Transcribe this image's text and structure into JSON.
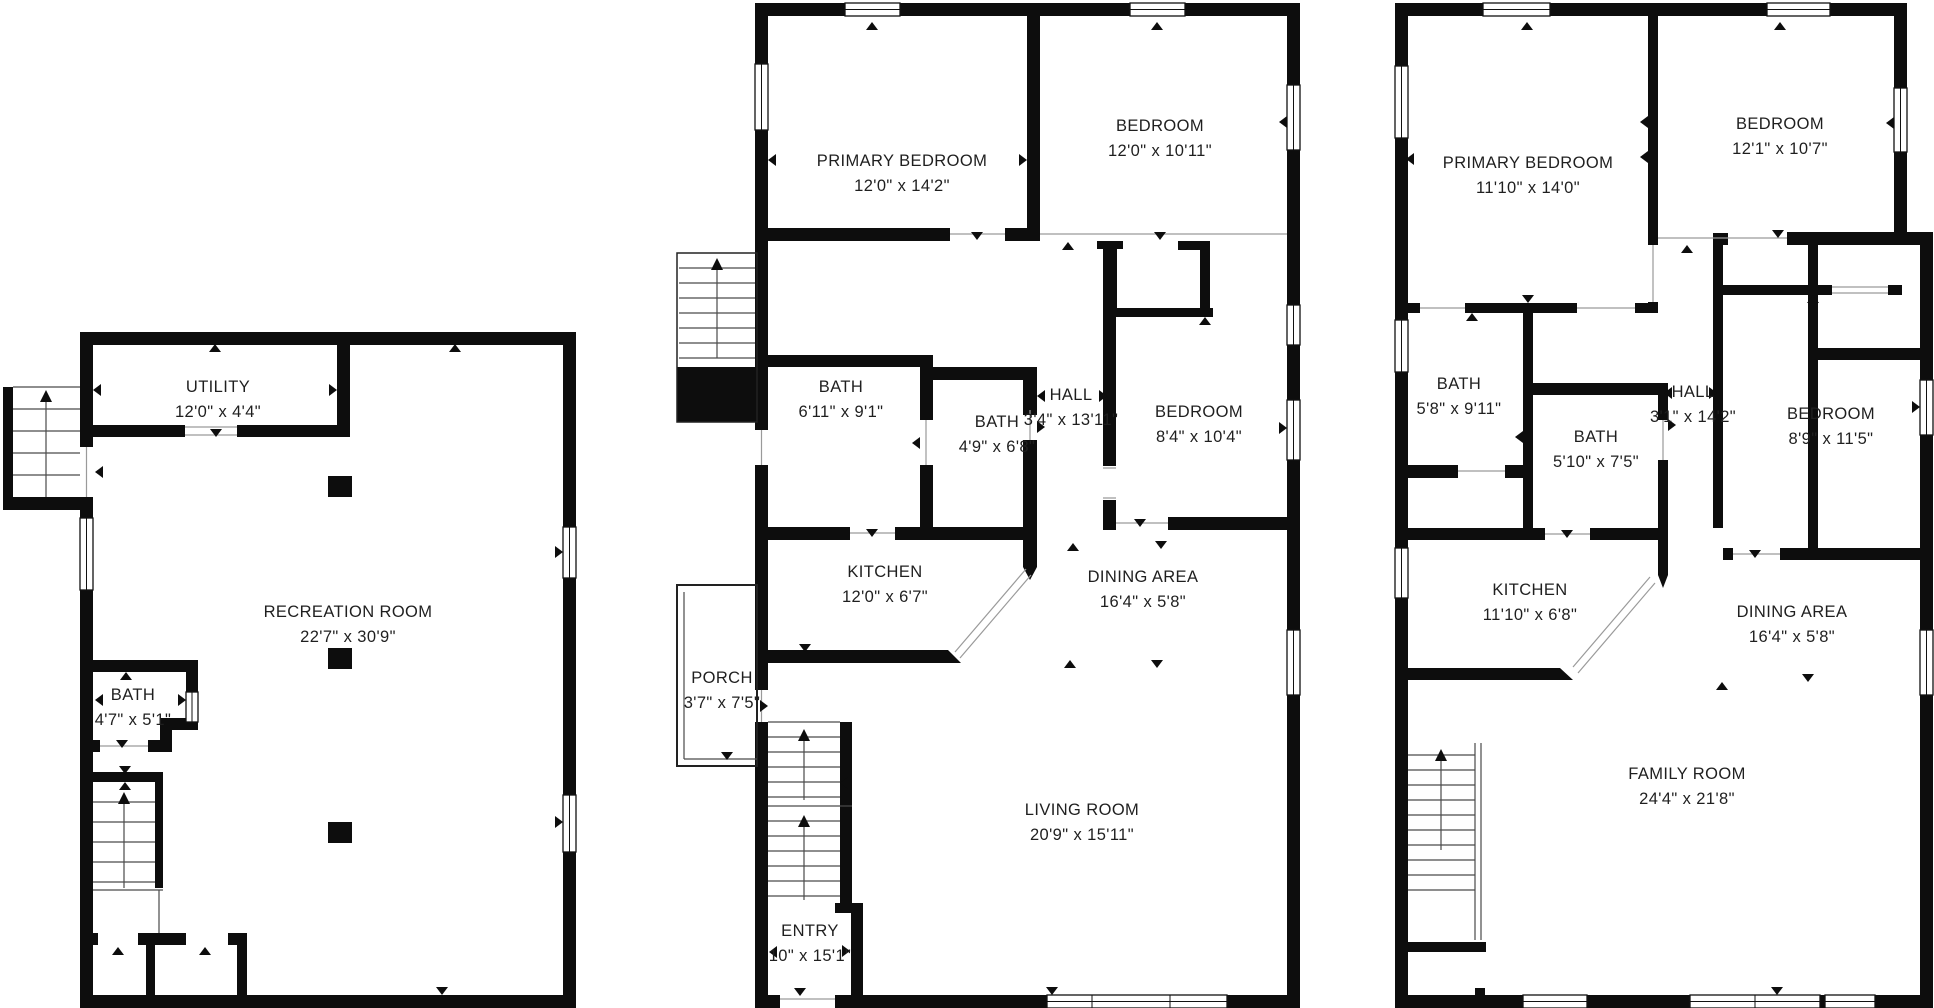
{
  "colors": {
    "background": "#ffffff",
    "wall": "#0d0d0d",
    "label_text": "#1f1f1f"
  },
  "plans": [
    {
      "id": "basement",
      "rooms": [
        {
          "name": "UTILITY",
          "dims": "12'0\" x 4'4\""
        },
        {
          "name": "RECREATION ROOM",
          "dims": "22'7\" x 30'9\""
        },
        {
          "name": "BATH",
          "dims": "4'7\" x 5'1\""
        }
      ]
    },
    {
      "id": "main-level",
      "rooms": [
        {
          "name": "PRIMARY BEDROOM",
          "dims": "12'0\" x 14'2\""
        },
        {
          "name": "BEDROOM",
          "dims": "12'0\" x 10'11\""
        },
        {
          "name": "BATH",
          "dims": "6'11\" x 9'1\""
        },
        {
          "name": "BATH",
          "dims": "4'9\" x 6'8\""
        },
        {
          "name": "HALL",
          "dims": "3'4\" x 13'11\""
        },
        {
          "name": "BEDROOM",
          "dims": "8'4\" x 10'4\""
        },
        {
          "name": "KITCHEN",
          "dims": "12'0\" x 6'7\""
        },
        {
          "name": "DINING AREA",
          "dims": "16'4\" x 5'8\""
        },
        {
          "name": "PORCH",
          "dims": "3'7\" x 7'5\""
        },
        {
          "name": "LIVING ROOM",
          "dims": "20'9\" x 15'11\""
        },
        {
          "name": "ENTRY",
          "dims": "10\" x 15'1\""
        }
      ]
    },
    {
      "id": "upper-level",
      "rooms": [
        {
          "name": "PRIMARY BEDROOM",
          "dims": "11'10\" x 14'0\""
        },
        {
          "name": "BEDROOM",
          "dims": "12'1\" x 10'7\""
        },
        {
          "name": "BATH",
          "dims": "5'8\" x 9'11\""
        },
        {
          "name": "BATH",
          "dims": "5'10\" x 7'5\""
        },
        {
          "name": "HALL",
          "dims": "3'1\" x 14'2\""
        },
        {
          "name": "BEDROOM",
          "dims": "8'9\" x 11'5\""
        },
        {
          "name": "KITCHEN",
          "dims": "11'10\" x 6'8\""
        },
        {
          "name": "DINING AREA",
          "dims": "16'4\" x 5'8\""
        },
        {
          "name": "FAMILY ROOM",
          "dims": "24'4\" x 21'8\""
        }
      ]
    }
  ]
}
